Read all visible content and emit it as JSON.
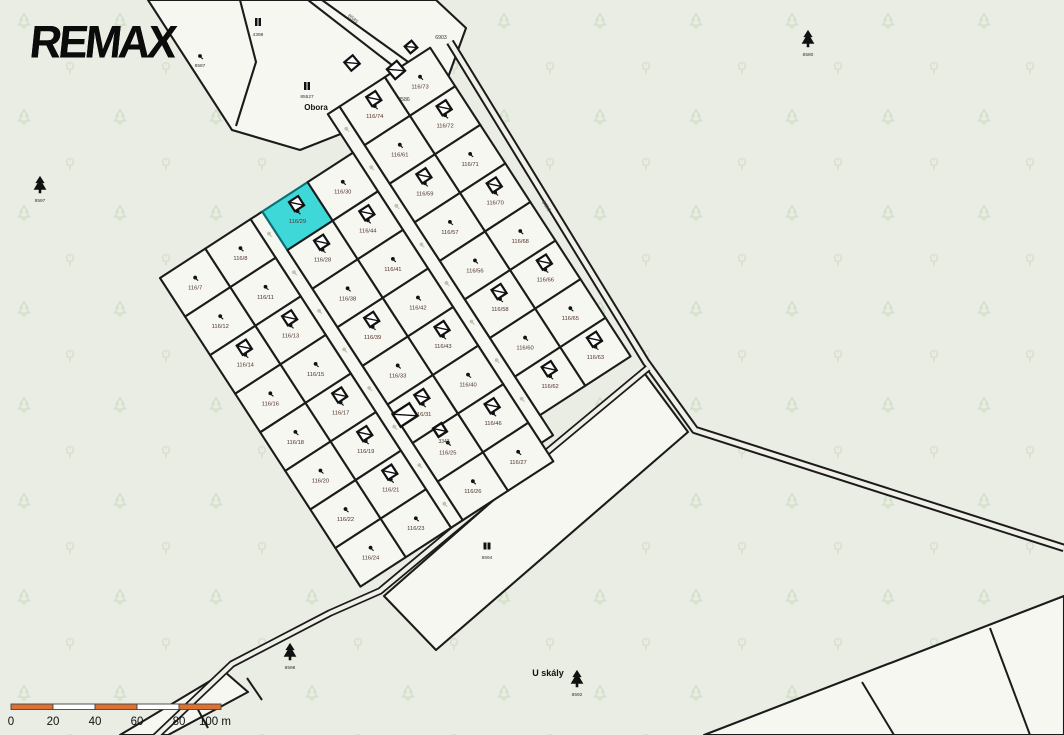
{
  "logo": {
    "text": "REMAX"
  },
  "colors": {
    "background_green": "#E9EDE3",
    "parcel_white": "#F7F7F2",
    "road_fill": "#F1F0E8",
    "line": "#1B1B1B",
    "selected_parcel_fill": "#3FD8D8",
    "selected_parcel_stroke": "#0D6E74",
    "parcel_label": "#503028",
    "faint_tree": "#D2DFC9",
    "ghost_marker": "#BAC5B2",
    "scale_orange": "#DB7232",
    "scale_white": "#FFFFFF"
  },
  "selected_parcel": "116/29",
  "cluster": {
    "origin": [
      160,
      278
    ],
    "angle_deg": -33,
    "cell_v": 46,
    "rows": {
      "r0": [
        0,
        54
      ],
      "r1": [
        54,
        108
      ],
      "r2": [
        122,
        176
      ],
      "r3": [
        176,
        230
      ],
      "r4": [
        244,
        298
      ],
      "r5": [
        298,
        352
      ]
    },
    "streets": [
      {
        "u": [
          108,
          122
        ],
        "v": [
          0,
          368
        ]
      },
      {
        "u": [
          230,
          244
        ],
        "v": [
          -46,
          346
        ]
      }
    ],
    "parcels": [
      {
        "r": "r0",
        "c": 0,
        "label": "116/7"
      },
      {
        "r": "r0",
        "c": 1,
        "label": "116/12"
      },
      {
        "r": "r0",
        "c": 2,
        "label": "116/14",
        "building": true
      },
      {
        "r": "r0",
        "c": 3,
        "label": "116/16"
      },
      {
        "r": "r0",
        "c": 4,
        "label": "116/18"
      },
      {
        "r": "r0",
        "c": 5,
        "label": "116/20"
      },
      {
        "r": "r0",
        "c": 6,
        "label": "116/22"
      },
      {
        "r": "r0",
        "c": 7,
        "label": "116/24"
      },
      {
        "r": "r1",
        "c": 0,
        "label": "116/8"
      },
      {
        "r": "r1",
        "c": 1,
        "label": "116/11"
      },
      {
        "r": "r1",
        "c": 2,
        "label": "116/13",
        "building": true
      },
      {
        "r": "r1",
        "c": 3,
        "label": "116/15"
      },
      {
        "r": "r1",
        "c": 4,
        "label": "116/17",
        "building": true
      },
      {
        "r": "r1",
        "c": 5,
        "label": "116/19",
        "building": true
      },
      {
        "r": "r1",
        "c": 6,
        "label": "116/21",
        "building": true
      },
      {
        "r": "r1",
        "c": 7,
        "label": "116/23"
      },
      {
        "r": "r2",
        "c": 0,
        "label": "116/29",
        "selected": true,
        "building": true
      },
      {
        "r": "r2",
        "c": 1,
        "label": "116/28",
        "building": true
      },
      {
        "r": "r2",
        "c": 2,
        "label": "116/38"
      },
      {
        "r": "r2",
        "c": 3,
        "label": "116/39",
        "building": true
      },
      {
        "r": "r2",
        "c": 4,
        "label": "116/33"
      },
      {
        "r": "r2",
        "c": 5,
        "label": "116/31",
        "building": true
      },
      {
        "r": "r2",
        "c": 6,
        "label": "116/25"
      },
      {
        "r": "r2",
        "c": 7,
        "label": "116/26"
      },
      {
        "r": "r3",
        "c": 0,
        "label": "116/30"
      },
      {
        "r": "r3",
        "c": 1,
        "label": "116/44",
        "building": true
      },
      {
        "r": "r3",
        "c": 2,
        "label": "116/41"
      },
      {
        "r": "r3",
        "c": 3,
        "label": "116/42"
      },
      {
        "r": "r3",
        "c": 4,
        "label": "116/43",
        "building": true
      },
      {
        "r": "r3",
        "c": 5,
        "label": "116/40"
      },
      {
        "r": "r3",
        "c": 6,
        "label": "116/46",
        "building": true
      },
      {
        "r": "r3",
        "c": 7,
        "label": "116/27"
      },
      {
        "r": "r4",
        "c": -1,
        "label": "116/74",
        "building": true
      },
      {
        "r": "r4",
        "c": 0,
        "label": "116/61"
      },
      {
        "r": "r4",
        "c": 1,
        "label": "116/59",
        "building": true
      },
      {
        "r": "r4",
        "c": 2,
        "label": "116/57"
      },
      {
        "r": "r4",
        "c": 3,
        "label": "116/56"
      },
      {
        "r": "r4",
        "c": 4,
        "label": "116/58",
        "building": true
      },
      {
        "r": "r4",
        "c": 5,
        "label": "116/60"
      },
      {
        "r": "r4",
        "c": 6,
        "label": "116/62",
        "building": true
      },
      {
        "r": "r5",
        "c": -1,
        "label": "116/73"
      },
      {
        "r": "r5",
        "c": 0,
        "label": "116/72",
        "building": true
      },
      {
        "r": "r5",
        "c": 1,
        "label": "116/71"
      },
      {
        "r": "r5",
        "c": 2,
        "label": "116/70",
        "building": true
      },
      {
        "r": "r5",
        "c": 3,
        "label": "116/68"
      },
      {
        "r": "r5",
        "c": 4,
        "label": "116/66",
        "building": true
      },
      {
        "r": "r5",
        "c": 5,
        "label": "116/65"
      },
      {
        "r": "r5",
        "c": 6,
        "label": "116/63",
        "building": true
      }
    ]
  },
  "top_area": {
    "outline": [
      [
        148,
        0
      ],
      [
        436,
        0
      ],
      [
        466,
        28
      ],
      [
        442,
        94
      ],
      [
        300,
        150
      ],
      [
        232,
        130
      ]
    ],
    "inner_lines": [
      [
        [
          240,
          0
        ],
        [
          256,
          62
        ],
        [
          236,
          126
        ]
      ]
    ],
    "road_lines": [
      [
        [
          308,
          0
        ],
        [
          424,
          90
        ]
      ],
      [
        [
          322,
          0
        ],
        [
          436,
          82
        ]
      ]
    ],
    "buildings": [
      {
        "x": 352,
        "y": 63,
        "s": 11
      },
      {
        "x": 396,
        "y": 70,
        "s": 13
      },
      {
        "x": 411,
        "y": 47,
        "s": 9
      }
    ],
    "number_labels": [
      {
        "text": "8586",
        "x": 404,
        "y": 101
      },
      {
        "text": "6903",
        "x": 441,
        "y": 39
      }
    ],
    "square_markers": [
      {
        "number": "4398",
        "x": 258,
        "y": 22,
        "num_y": 36
      },
      {
        "number": "85527",
        "x": 307,
        "y": 86,
        "num_y": 98
      }
    ],
    "place_label": {
      "text": "Obora",
      "x": 316,
      "y": 110
    }
  },
  "roads": {
    "road_a": [
      [
        450,
        42
      ],
      [
        646,
        362
      ],
      [
        695,
        430
      ],
      [
        1064,
        548
      ]
    ],
    "road_b": [
      [
        150,
        742
      ],
      [
        232,
        664
      ],
      [
        330,
        613
      ],
      [
        380,
        591
      ],
      [
        648,
        368
      ]
    ],
    "labels": [
      {
        "text": "8585",
        "x": 352,
        "y": 20,
        "rot": 39
      },
      {
        "text": "8590",
        "x": 545,
        "y": 207,
        "rot": 57
      }
    ]
  },
  "fields": {
    "bottom_field": [
      [
        384,
        596
      ],
      [
        642,
        370
      ],
      [
        688,
        432
      ],
      [
        436,
        650
      ]
    ],
    "bottom_right": {
      "outline": [
        [
          704,
          735
        ],
        [
          1064,
          596
        ],
        [
          1064,
          735
        ]
      ],
      "inner_lines": [
        [
          [
            862,
            682
          ],
          [
            894,
            735
          ]
        ],
        [
          [
            990,
            628
          ],
          [
            1030,
            735
          ]
        ]
      ]
    },
    "bottom_left_sliver": [
      [
        120,
        735
      ],
      [
        225,
        672
      ],
      [
        248,
        692
      ],
      [
        168,
        735
      ]
    ],
    "sliver_ticks": [
      [
        [
          196,
          706
        ],
        [
          208,
          728
        ]
      ],
      [
        [
          247,
          678
        ],
        [
          262,
          700
        ]
      ]
    ]
  },
  "landmarks": {
    "trees": [
      {
        "number": "8597",
        "x": 40,
        "y": 186
      },
      {
        "number": "8580",
        "x": 808,
        "y": 40
      },
      {
        "number": "8598",
        "x": 290,
        "y": 653
      },
      {
        "number": "8592",
        "x": 577,
        "y": 680
      }
    ],
    "building_markers": [
      {
        "number": "8594",
        "x": 487,
        "y": 546
      }
    ],
    "orchard_markers": [
      {
        "number": "8587",
        "x": 200,
        "y": 57
      }
    ],
    "standalone_buildings": [
      {
        "x": 405,
        "y": 415,
        "w": 20,
        "h": 15,
        "label": ""
      },
      {
        "x": 440,
        "y": 430,
        "w": 10,
        "h": 10,
        "label": "3343"
      }
    ],
    "place_label": {
      "text": "U skály",
      "x": 548,
      "y": 676
    }
  },
  "scale_bar": {
    "x0": 11,
    "x1": 221,
    "y": 704,
    "h": 5.5,
    "segments": [
      "orange",
      "white",
      "orange",
      "white",
      "orange"
    ],
    "labels": [
      {
        "text": "0",
        "x": 11
      },
      {
        "text": "20",
        "x": 53
      },
      {
        "text": "40",
        "x": 95
      },
      {
        "text": "60",
        "x": 137
      },
      {
        "text": "80",
        "x": 179
      },
      {
        "text": "100 m",
        "x": 215
      }
    ]
  }
}
